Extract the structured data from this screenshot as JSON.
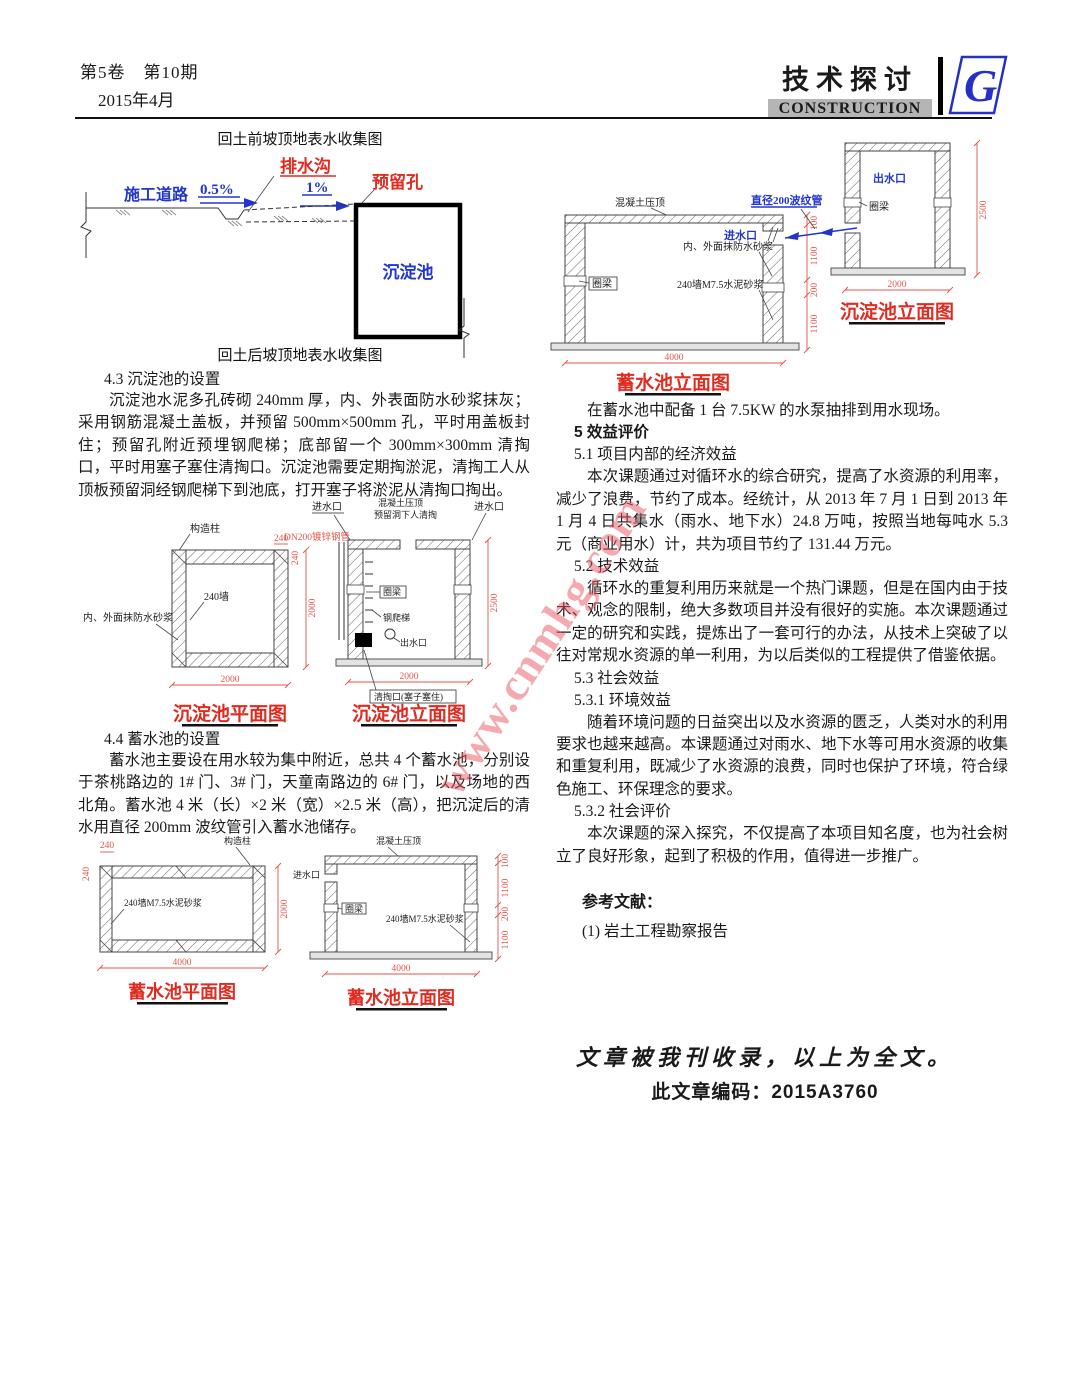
{
  "header": {
    "volume_issue": "第5卷　第10期",
    "date": "2015年4月",
    "journal_title": "技术探讨",
    "journal_subtitle": "CONSTRUCTION",
    "logo_letter": "G"
  },
  "watermark": "www.cnmhg.com",
  "fig_collection": {
    "caption_before": "回土前坡顶地表水收集图",
    "caption_after": "回土后坡顶地表水收集图",
    "drain_label": "排水沟",
    "hole_label": "预留孔",
    "road_label": "施工道路",
    "slope1": "0.5%",
    "slope2": "1%",
    "tank_label": "沉淀池"
  },
  "sec43": {
    "heading": "4.3 沉淀池的设置",
    "body": "沉淀池水泥多孔砖砌 240mm 厚，内、外表面防水砂浆抹灰；采用钢筋混凝土盖板，并预留 500mm×500mm 孔，平时用盖板封住；预留孔附近预埋钢爬梯；底部留一个 300mm×300mm 清掏口，平时用塞子塞住清掏口。沉淀池需要定期掏淤泥，清掏工人从顶板预留洞经钢爬梯下到池底，打开塞子将淤泥从清掏口掏出。"
  },
  "sec44": {
    "heading": "4.4 蓄水池的设置",
    "body": "蓄水池主要设在用水较为集中附近，总共 4 个蓄水池，分别设于茶桃路边的 1# 门、3# 门，天童南路边的 6# 门，以及场地的西北角。蓄水池 4 米（长）×2 米（宽）×2.5 米（高），把沉淀后的清水用直径 200mm 波纹管引入蓄水池储存。"
  },
  "fig_right": {
    "res_elev": {
      "caption": "蓄水池立面图",
      "coping": "混凝土压顶",
      "pipe": "直径200波纹管",
      "inlet": "进水口",
      "plaster": "内、外面抹防水砂浆",
      "wall": "240墙M7.5水泥砂浆",
      "ring": "圈梁",
      "dim_w": "4000",
      "dims_v": [
        "100",
        "1100",
        "200",
        "1100"
      ]
    },
    "sed_elev": {
      "caption": "沉淀池立面图",
      "outlet": "出水口",
      "ring": "圈梁",
      "dim_w": "2000",
      "dim_h": "2500"
    }
  },
  "fig_sed": {
    "plan": {
      "caption": "沉淀池平面图",
      "column": "构造柱",
      "wall": "240墙",
      "plaster": "内、外面抹防水砂浆",
      "dim_240t": "240",
      "dim_240s": "240",
      "dim_h": "2000",
      "dim_w": "2000"
    },
    "elev": {
      "caption": "沉淀池立面图",
      "inlet_l": "进水口",
      "inlet_r": "进水口",
      "coping": "混凝土压顶",
      "hole": "预留洞下人清掏",
      "pipe": "DN200镀锌钢管",
      "ring": "圈梁",
      "ladder": "钢爬梯",
      "outlet": "出水口",
      "clean": "清掏口(塞子塞住)",
      "dim_w": "2000",
      "dim_h": "2500"
    }
  },
  "fig_res": {
    "plan": {
      "caption": "蓄水池平面图",
      "column": "构造柱",
      "wall": "240墙M7.5水泥砂浆",
      "dim_240t": "240",
      "dim_240s": "240",
      "dim_h": "2000",
      "dim_w": "4000"
    },
    "elev": {
      "caption": "蓄水池立面图",
      "coping": "混凝土压顶",
      "inlet": "进水口",
      "ring": "圈梁",
      "wall": "240墙M7.5水泥砂浆",
      "dims_v": [
        "100",
        "1100",
        "200",
        "1100"
      ],
      "dim_w": "4000"
    }
  },
  "right_col": {
    "p0": "在蓄水池中配备 1 台 7.5KW 的水泵抽排到用水现场。",
    "h5": "5 效益评价",
    "h51": "5.1 项目内部的经济效益",
    "p51": "本次课题通过对循环水的综合研究，提高了水资源的利用率，减少了浪费，节约了成本。经统计，从 2013 年 7 月 1 日到 2013 年 1 月 4 日共集水（雨水、地下水）24.8 万吨，按照当地每吨水 5.3 元（商业用水）计，共为项目节约了 131.44 万元。",
    "h52": "5.2 技术效益",
    "p52": "循环水的重复利用历来就是一个热门课题，但是在国内由于技术、观念的限制，绝大多数项目并没有很好的实施。本次课题通过一定的研究和实践，提炼出了一套可行的办法，从技术上突破了以往对常规水资源的单一利用，为以后类似的工程提供了借鉴依据。",
    "h53": "5.3 社会效益",
    "h531": "5.3.1 环境效益",
    "p531": "随着环境问题的日益突出以及水资源的匮乏，人类对水的利用要求也越来越高。本课题通过对雨水、地下水等可用水资源的收集和重复利用，既减少了水资源的浪费，同时也保护了环境，符合绿色施工、环保理念的要求。",
    "h532": "5.3.2 社会评价",
    "p532": "本次课题的深入探究，不仅提高了本项目知名度，也为社会树立了良好形象，起到了积极的作用，值得进一步推广。",
    "ref_heading": "参考文献：",
    "ref1": "(1) 岩土工程勘察报告"
  },
  "footer": {
    "line1": "文章被我刊收录，以上为全文。",
    "line2": "此文章编码：2015A3760"
  }
}
